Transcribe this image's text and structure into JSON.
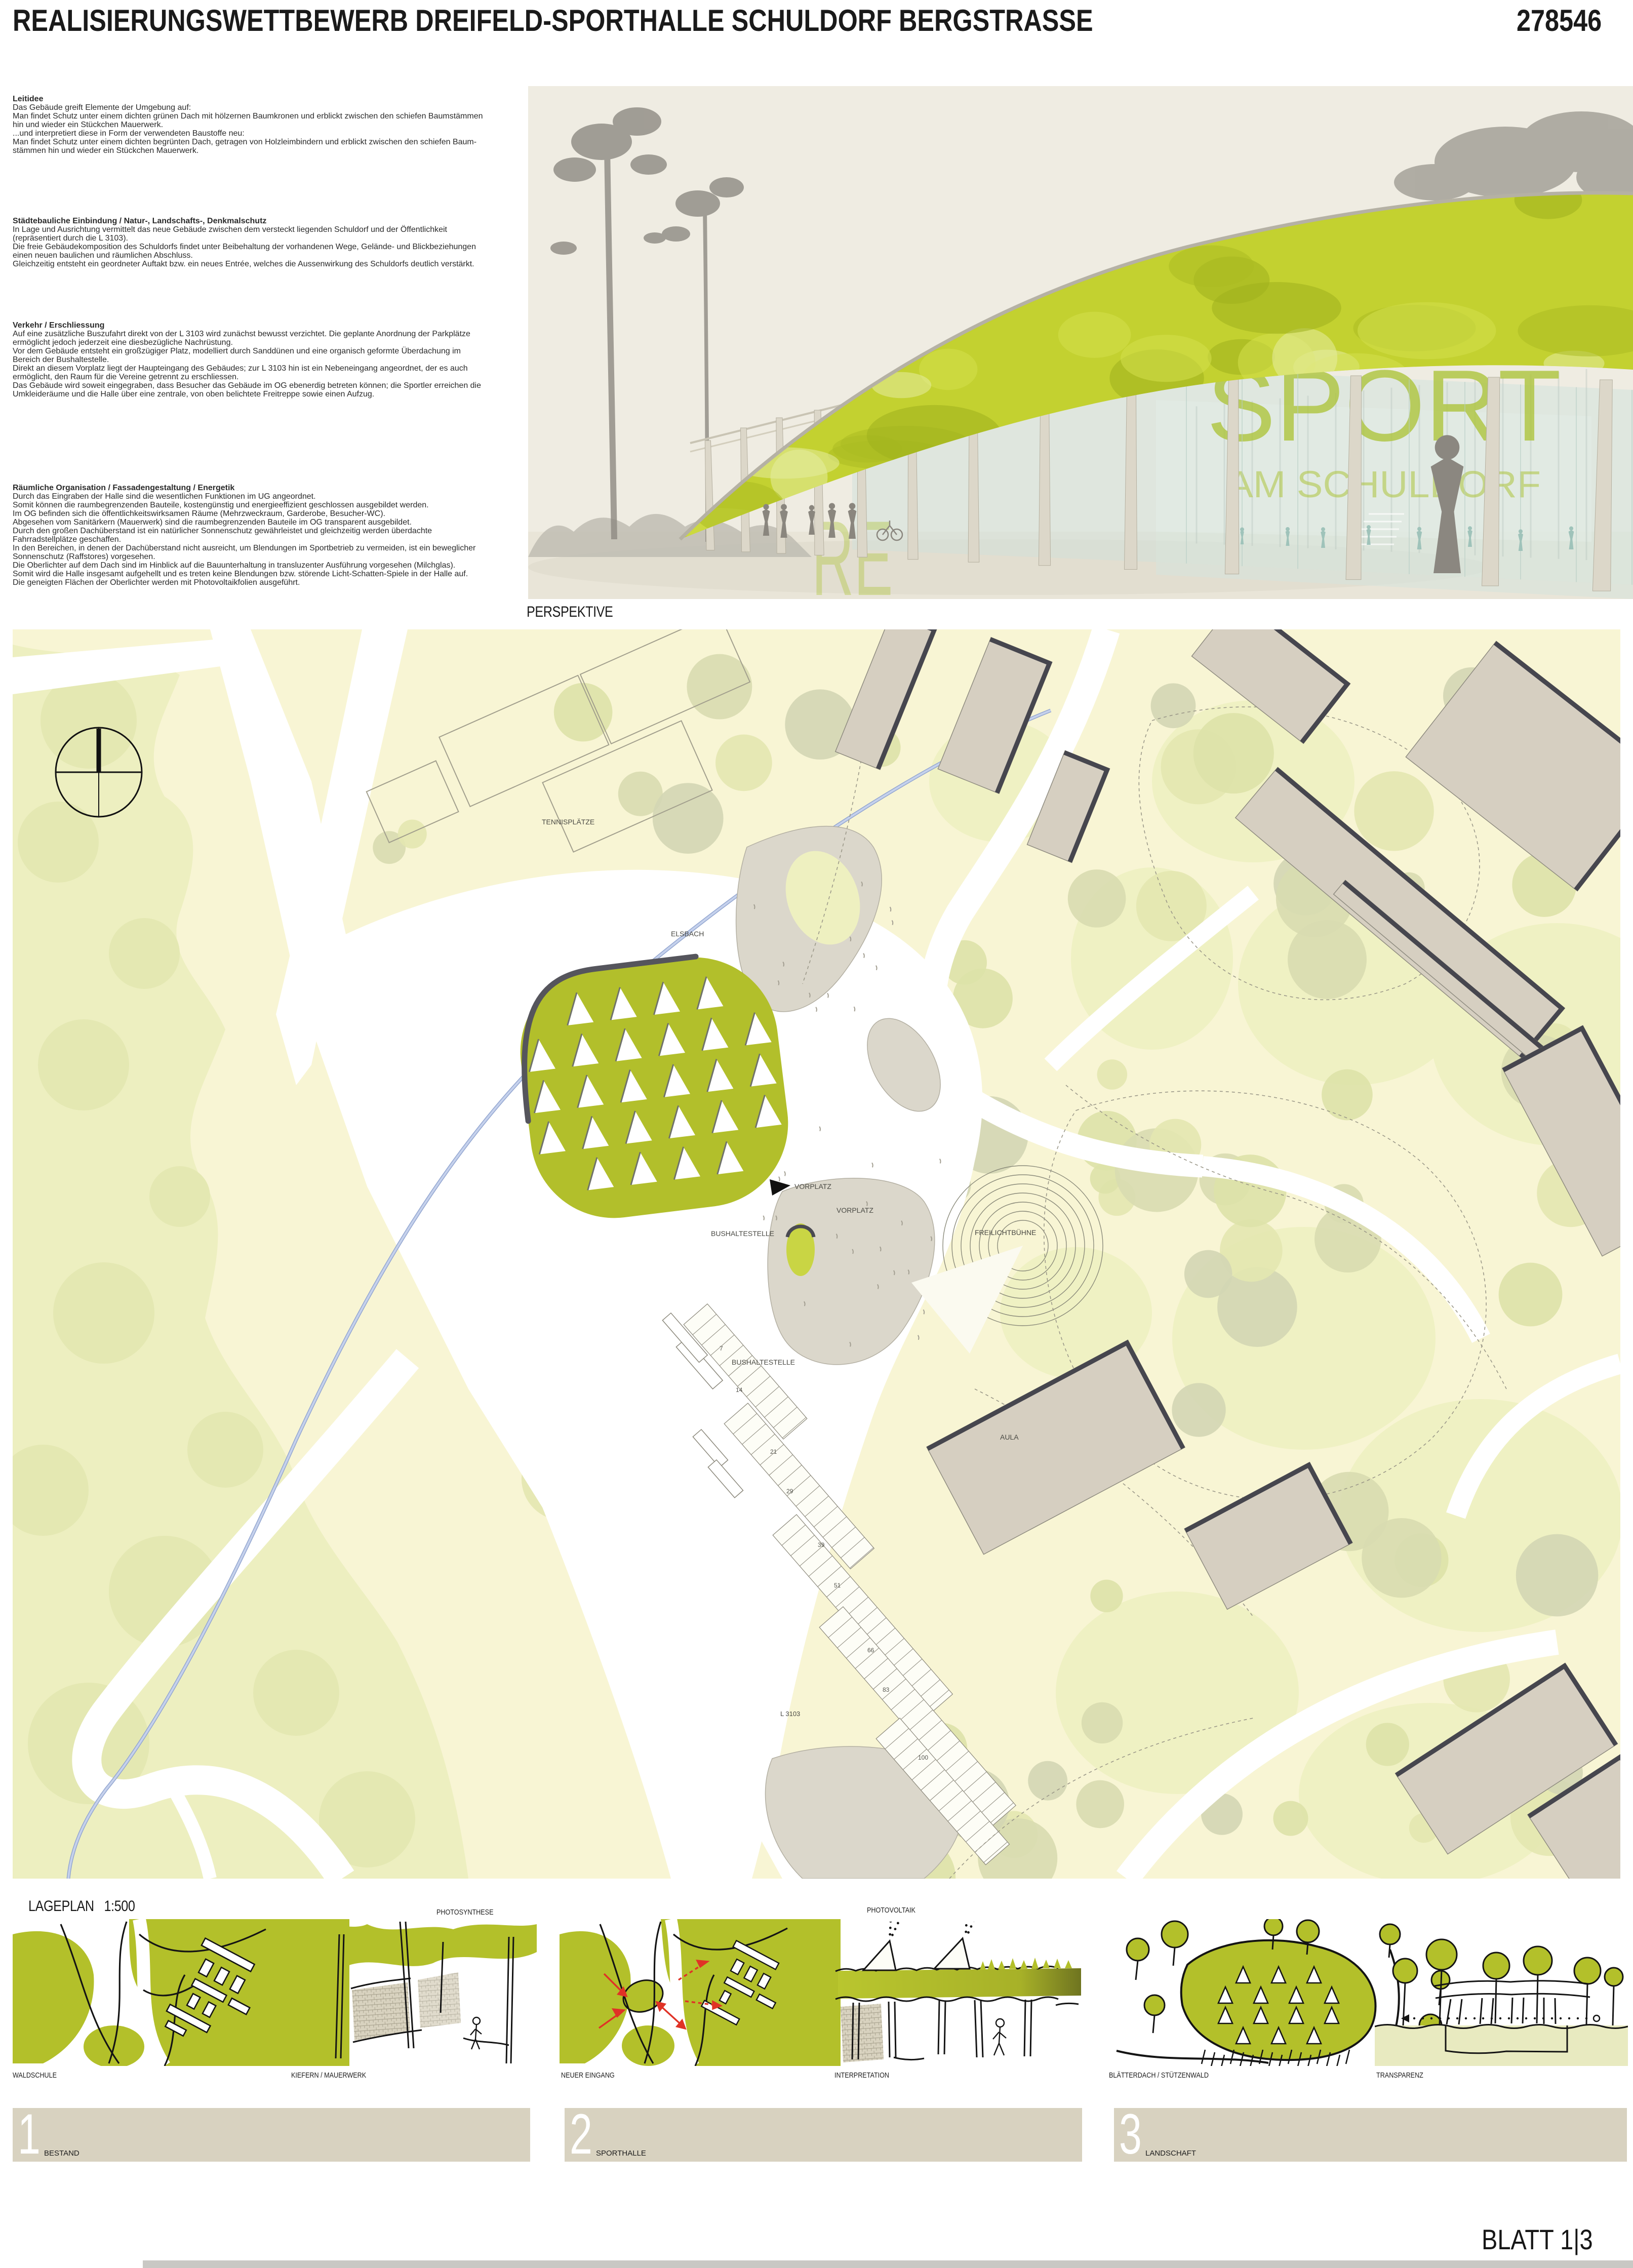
{
  "header": {
    "title": "REALISIERUNGSWETTBEWERB DREIFELD-SPORTHALLE SCHULDORF BERGSTRASSE",
    "number": "278546"
  },
  "text_column": {
    "sections": [
      {
        "heading": "Leitidee",
        "lines": [
          "Das Gebäude greift Elemente der Umgebung auf:",
          "Man findet Schutz unter einem dichten grünen Dach mit hölzernen Baumkronen und erblickt zwischen den schiefen Baumstämmen",
          "hin und wieder ein Stückchen Mauerwerk.",
          "...und interpretiert diese in Form der verwendeten Baustoffe neu:",
          "Man findet Schutz unter einem dichten begrünten Dach, getragen von Holzleimbindern und erblickt zwischen den schiefen Baum-",
          "stämmen hin und wieder ein Stückchen Mauerwerk."
        ]
      },
      {
        "heading": "Städtebauliche Einbindung / Natur-, Landschafts-, Denkmalschutz",
        "lines": [
          "In Lage und Ausrichtung vermittelt das neue Gebäude zwischen dem versteckt liegenden Schuldorf und der Öffentlichkeit",
          "(repräsentiert durch die L 3103).",
          "Die freie Gebäudekomposition des Schuldorfs findet unter Beibehaltung der vorhandenen Wege, Gelände- und Blickbeziehungen",
          "einen neuen baulichen und räumlichen Abschluss.",
          "Gleichzeitig entsteht ein geordneter Auftakt bzw. ein neues Entrée, welches die Aussenwirkung des Schuldorfs deutlich verstärkt."
        ]
      },
      {
        "heading": "Verkehr / Erschliessung",
        "lines": [
          "Auf eine zusätzliche Buszufahrt direkt von der L 3103 wird zunächst bewusst verzichtet. Die geplante Anordnung der Parkplätze",
          "ermöglicht jedoch jederzeit eine diesbezügliche Nachrüstung.",
          "Vor dem Gebäude entsteht ein großzügiger Platz, modelliert durch Sanddünen und eine organisch geformte Überdachung im",
          "Bereich der Bushaltestelle.",
          "Direkt an diesem Vorplatz liegt der Haupteingang des Gebäudes; zur L 3103 hin ist ein Nebeneingang angeordnet, der es auch",
          "ermöglicht, den Raum für die Vereine getrennt zu erschliessen.",
          "Das Gebäude wird soweit eingegraben, dass Besucher das Gebäude im OG ebenerdig betreten können; die Sportler erreichen die",
          "Umkleideräume und die Halle über eine zentrale, von oben belichtete Freitreppe sowie einen Aufzug."
        ]
      },
      {
        "heading": "Räumliche Organisation / Fassadengestaltung / Energetik",
        "lines": [
          "Durch das Eingraben der Halle sind die wesentlichen Funktionen im UG angeordnet.",
          "Somit können die raumbegrenzenden Bauteile, kostengünstig und energieeffizient geschlossen ausgebildet werden.",
          "Im OG befinden sich die öffentlichkeitswirksamen Räume (Mehrzweckraum, Garderobe, Besucher-WC).",
          "Abgesehen vom Sanitärkern (Mauerwerk) sind die raumbegrenzenden Bauteile im OG transparent ausgebildet.",
          "Durch den großen Dachüberstand ist ein natürlicher Sonnenschutz gewährleistet und gleichzeitig werden überdachte",
          "Fahrradstellplätze geschaffen.",
          "In den Bereichen, in denen der Dachüberstand nicht ausreicht, um Blendungen im Sportbetrieb zu vermeiden, ist ein beweglicher",
          "Sonnenschutz (Raffstores) vorgesehen.",
          "Die Oberlichter auf dem Dach sind im Hinblick auf die Bauunterhaltung in transluzenter Ausführung vorgesehen (Milchglas).",
          "Somit wird die Halle insgesamt aufgehellt und es treten keine Blendungen bzw. störende Licht-Schatten-Spiele in der Halle auf.",
          "Die geneigten Flächen der Oberlichter werden mit Photovoltaikfolien ausgeführt."
        ]
      }
    ]
  },
  "perspective": {
    "label": "PERSPEKTIVE",
    "glass_text": "SPORT",
    "glass_subtext": "AM SCHULDORF",
    "glass_side_text": "RE"
  },
  "siteplan": {
    "label": "LAGEPLAN   1:500",
    "map_labels": {
      "stream": "ELSBACH",
      "tennis": "TENNISPLÄTZE",
      "vorplatz": "VORPLATZ",
      "bus_stop": "BUSHALTESTELLE",
      "stage": "FREILICHTBÜHNE",
      "aula": "AULA",
      "road": "L 3103"
    },
    "parking_counts": [
      "7",
      "14",
      "21",
      "29",
      "39",
      "51",
      "66",
      "83",
      "100"
    ]
  },
  "sketches": [
    {
      "label": "WALDSCHULE"
    },
    {
      "label": "KIEFERN / MAUERWERK",
      "top_label": "PHOTOSYNTHESE"
    },
    {
      "label": "NEUER EINGANG"
    },
    {
      "label": "INTERPRETATION",
      "top_label": "PHOTOVOLTAIK"
    },
    {
      "label": "BLÄTTERDACH / STÜTZENWALD"
    },
    {
      "label": "TRANSPARENZ"
    }
  ],
  "section_bars": [
    {
      "number": "1",
      "label": "BESTAND"
    },
    {
      "number": "2",
      "label": "SPORTHALLE"
    },
    {
      "number": "3",
      "label": "LANDSCHAFT"
    }
  ],
  "footer": {
    "sheet": "BLATT 1|3"
  },
  "colors": {
    "leaf_green": "#b3c02a",
    "roof_green": "#c3d130",
    "plan_bg": "#f8f5d4",
    "forest": "#edefc0",
    "tree": "#dde2a8",
    "plaza_grey": "#dbd7cb",
    "building": "#d6cfc1",
    "building_shadow": "#46464e",
    "bar_beige": "#d8d2c0",
    "stream_blue": "#b3c3e4",
    "accent_red": "#e03226"
  }
}
